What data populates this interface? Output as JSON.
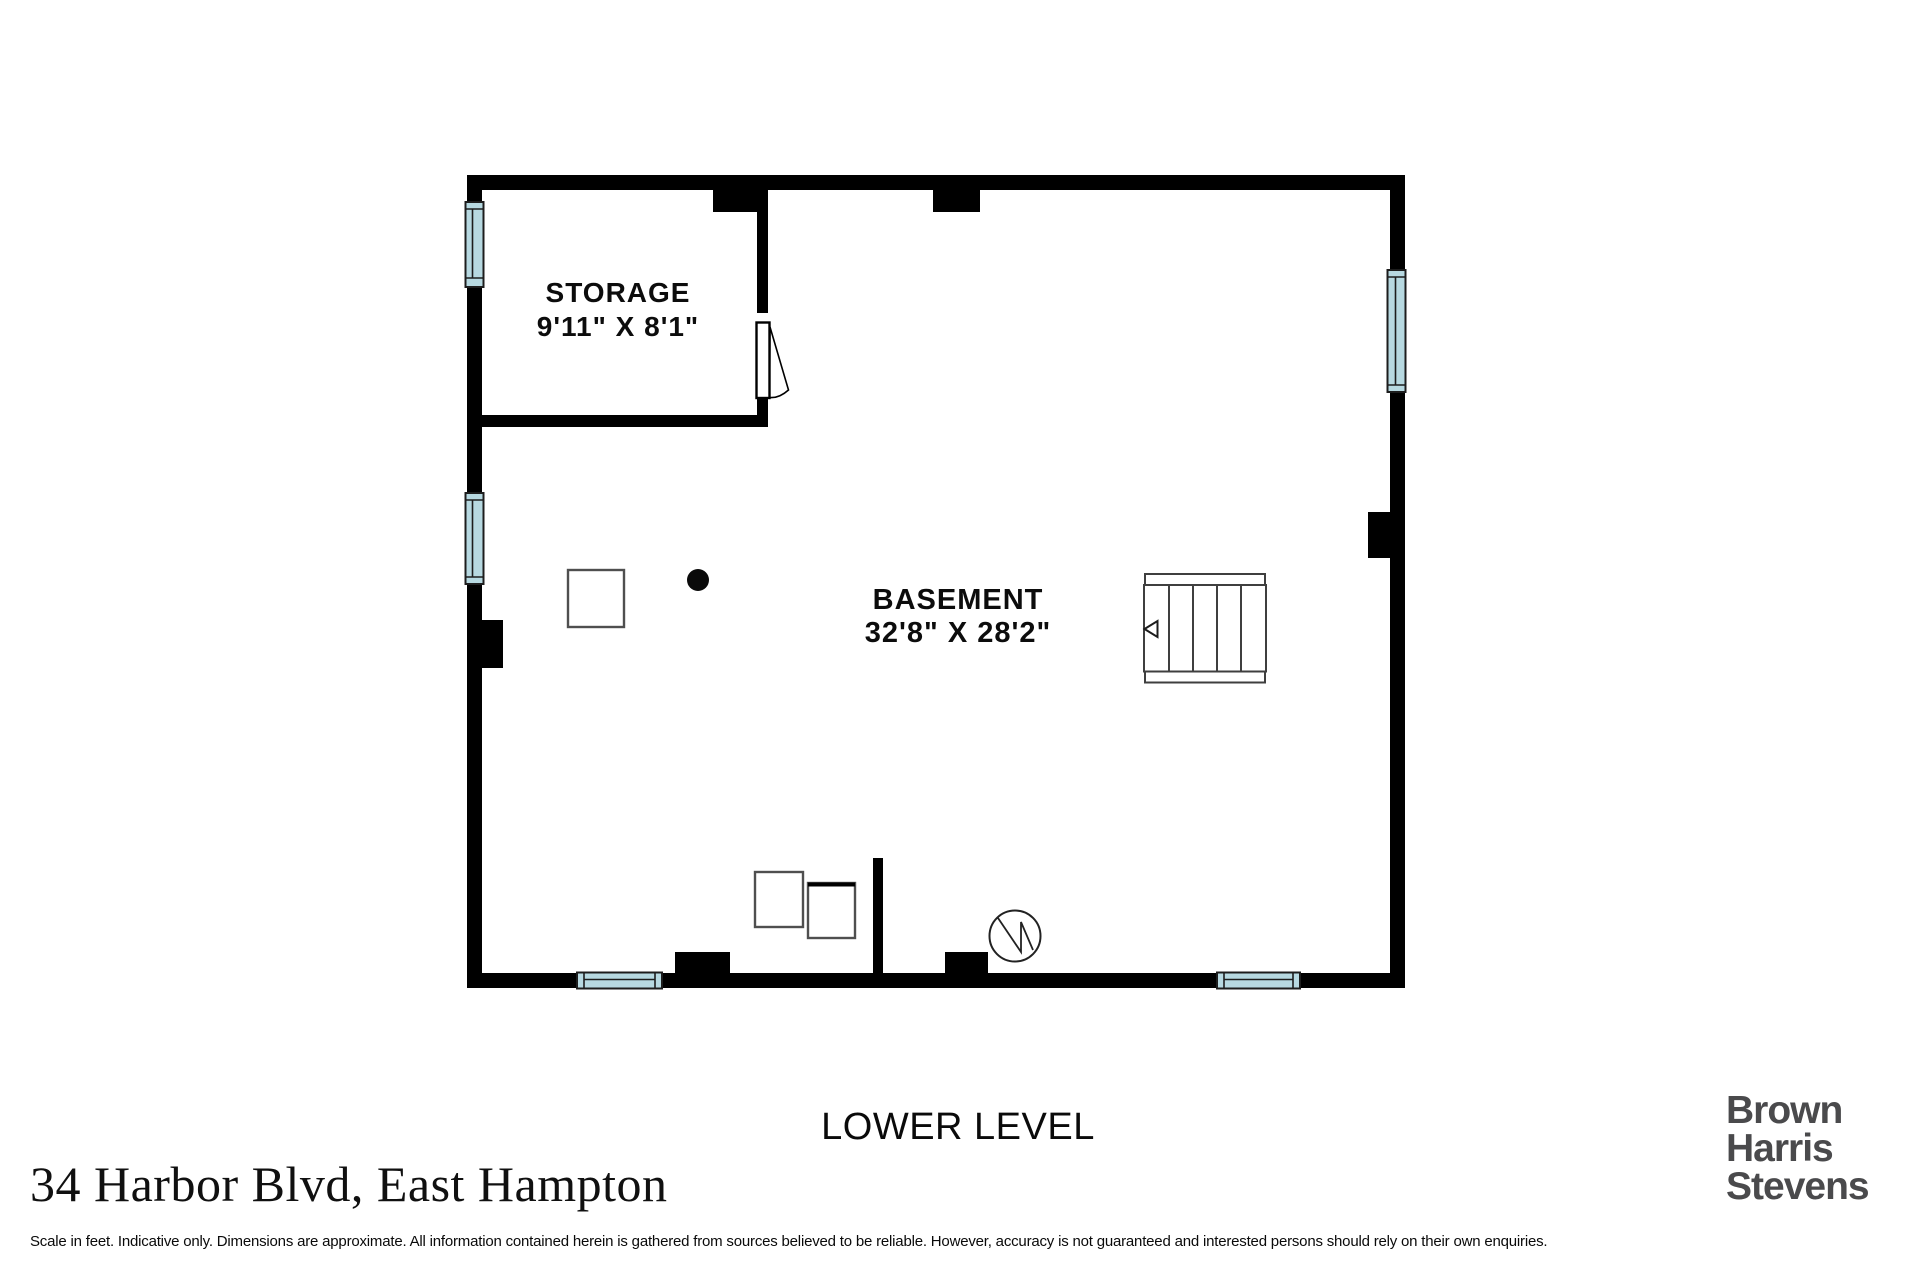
{
  "colors": {
    "wall": "#000000",
    "window_fill": "#b7d9e1",
    "line": "#1d1d1d",
    "stair_stroke": "#3f3f3f",
    "fixture_stroke": "#4f4f4f",
    "brand_gray": "#4a4a4c",
    "text": "#000000"
  },
  "rooms": {
    "storage": {
      "label": "STORAGE",
      "dims": "9'11\" X 8'1\""
    },
    "basement": {
      "label": "BASEMENT",
      "dims": "32'8\" X 28'2\""
    }
  },
  "level_label": "LOWER LEVEL",
  "footer": {
    "address": "34 Harbor Blvd, East Hampton",
    "disclaimer": "Scale in feet. Indicative only. Dimensions are approximate. All information contained herein is gathered from sources believed to be reliable. However, accuracy is not guaranteed and interested persons should rely on their own enquiries.",
    "brand": {
      "lines": [
        "Brown",
        "Harris",
        "Stevens"
      ]
    }
  }
}
